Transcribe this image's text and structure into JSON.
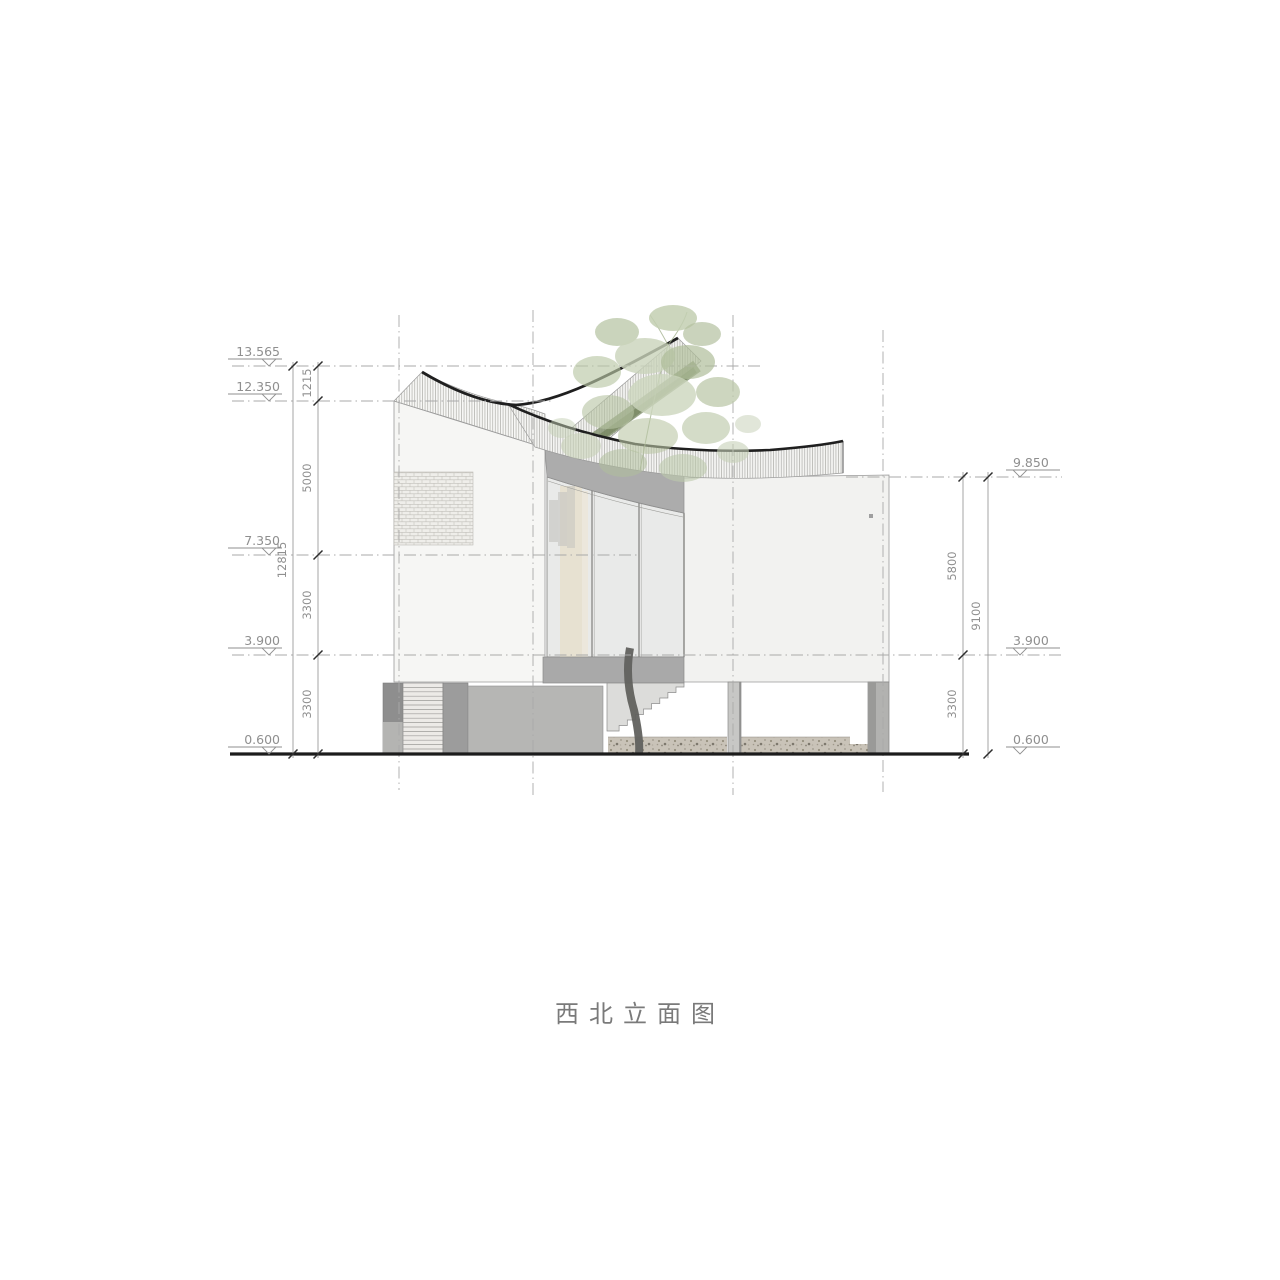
{
  "title": "西北立面图",
  "levels": {
    "left": [
      {
        "value": "13.565"
      },
      {
        "value": "12.350"
      },
      {
        "value": "7.350"
      },
      {
        "value": "3.900"
      },
      {
        "value": "0.600"
      }
    ],
    "right": [
      {
        "value": "9.850"
      },
      {
        "value": "3.900"
      },
      {
        "value": "0.600"
      }
    ]
  },
  "dimensions": {
    "left_chain": [
      "1215",
      "5000",
      "3300",
      "3300"
    ],
    "left_overall": "12815",
    "right_chain": [
      "5800",
      "3300"
    ],
    "right_overall": "9100"
  },
  "colors": {
    "outline_dark": "#1f1f1f",
    "annotation_grey": "#8f8f8f",
    "wall_white": "#f5f5f3",
    "fascia_grey": "#acacac",
    "slab_grey": "#a9a9a9",
    "canopy_green": "#b7c3a6",
    "hedge_green": "#76865f",
    "gravel_taupe": "#c9c3b8"
  }
}
